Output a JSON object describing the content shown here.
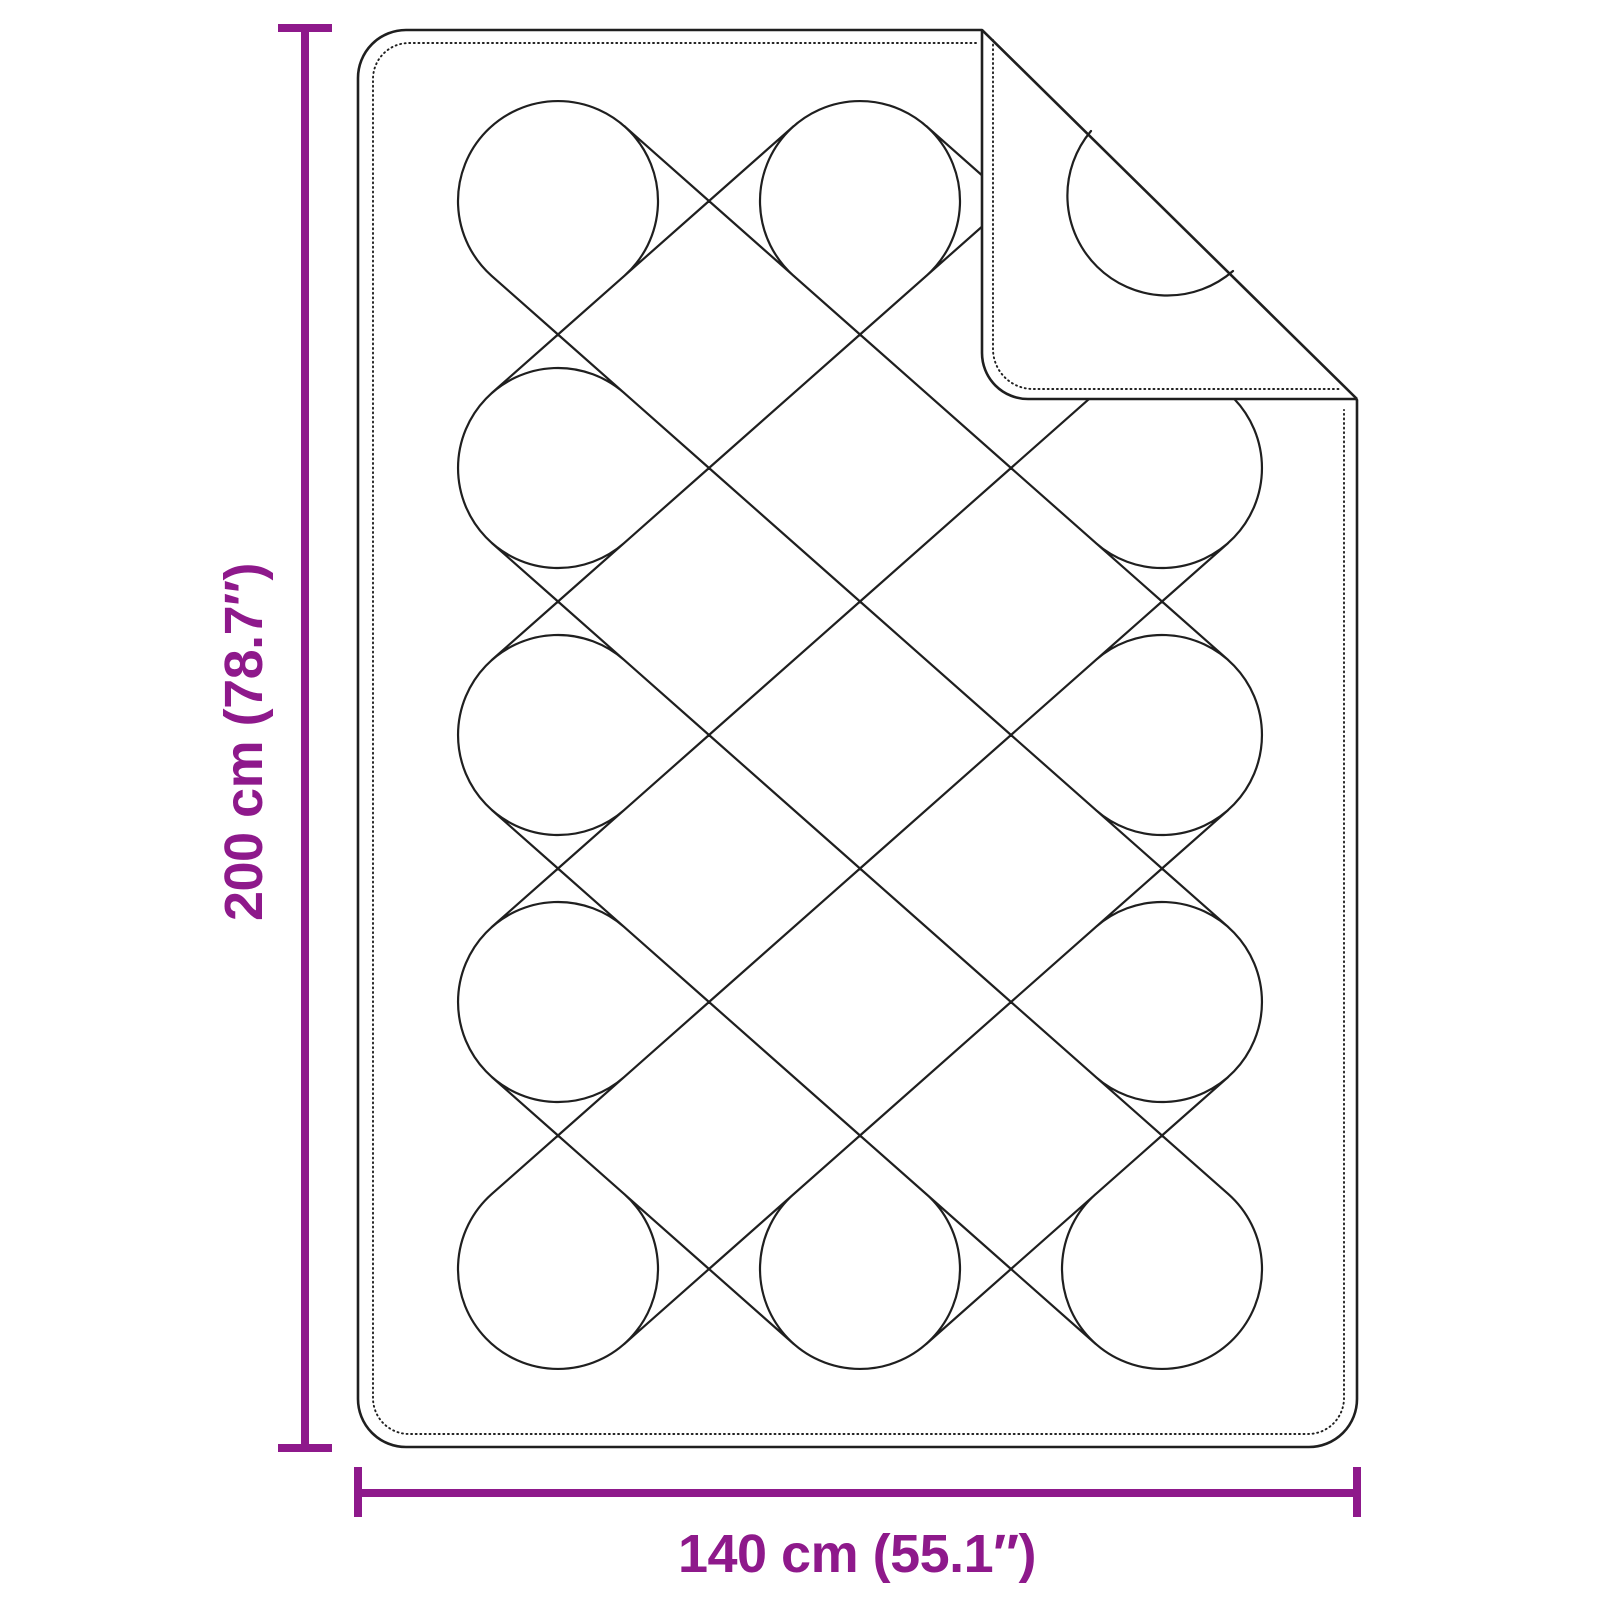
{
  "diagram": {
    "type": "product-dimension-diagram",
    "subject": "quilted blanket with folded corner",
    "style": "black line drawing on white"
  },
  "dimensions": {
    "height": {
      "label": "200 cm (78.7″)",
      "cm": 200,
      "inches": 78.7,
      "orientation": "vertical"
    },
    "width": {
      "label": "140 cm (55.1″)",
      "cm": 140,
      "inches": 55.1,
      "orientation": "horizontal"
    }
  },
  "colors": {
    "accent": "#8e198b",
    "line": "#1f1f1f",
    "background": "#ffffff"
  }
}
